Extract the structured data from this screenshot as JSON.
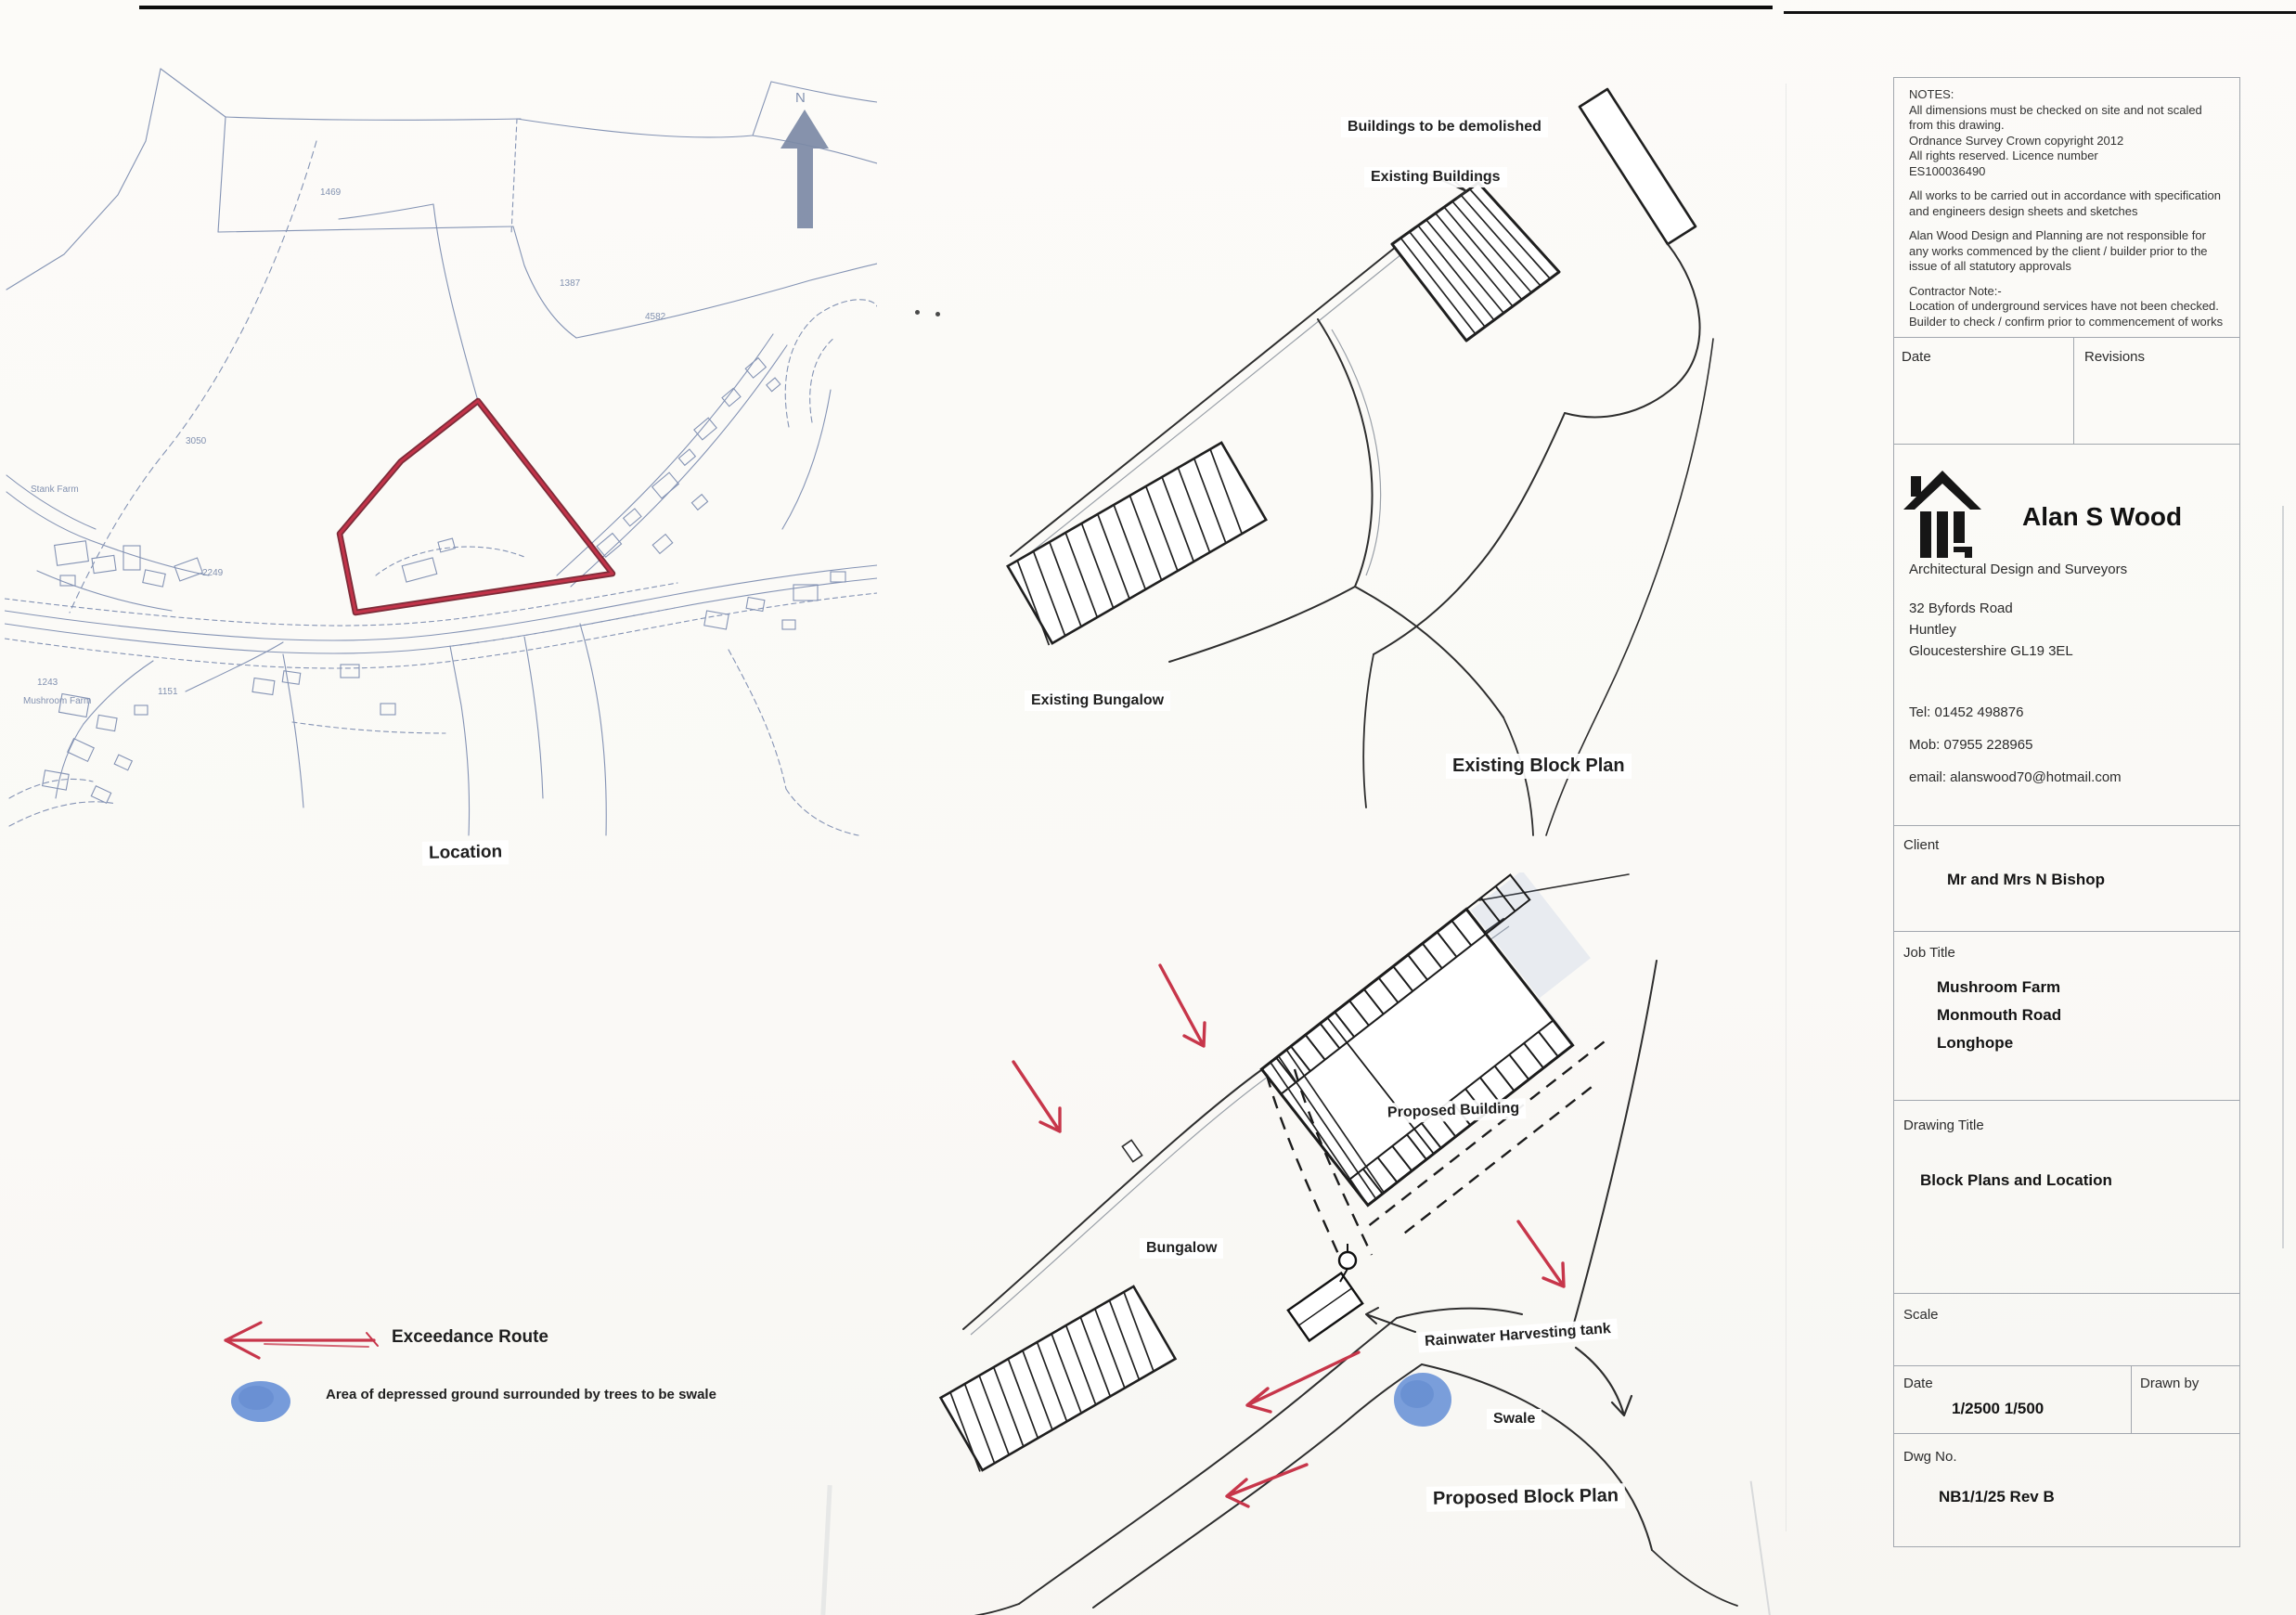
{
  "drawing": {
    "location_map": {
      "title": "Location",
      "north_label": "N",
      "parcel_numbers": [
        "1469",
        "1387",
        "4582",
        "3050",
        "2249",
        "1151",
        "1243"
      ],
      "farm_labels": [
        "Stank Farm",
        "Mushroom Farm"
      ],
      "site_boundary_color": "#c23349"
    },
    "existing_plan": {
      "demolish_label": "Buildings to be demolished",
      "existing_buildings_label": "Existing Buildings",
      "existing_bungalow_label": "Existing Bungalow",
      "title": "Existing Block Plan"
    },
    "proposed_plan": {
      "proposed_building_label": "Proposed Building",
      "bungalow_label": "Bungalow",
      "rainwater_tank_label": "Rainwater Harvesting tank",
      "swale_label": "Swale",
      "title": "Proposed Block Plan",
      "exceedance_arrow_color": "#c7364a",
      "swale_color": "#6f96d8"
    },
    "legend": {
      "exceedance_route_label": "Exceedance Route",
      "depressed_ground_label": "Area of depressed ground surrounded by trees to be swale"
    }
  },
  "title_block": {
    "notes": {
      "heading": "NOTES:",
      "lines": [
        "All dimensions must be checked on site and not scaled from this drawing.",
        "Ordnance Survey Crown copyright 2012",
        "All rights reserved. Licence number",
        "ES100036490",
        "All works to be carried out in accordance with specification and engineers design sheets and sketches",
        "Alan Wood Design and Planning are not responsible for any works commenced by the client / builder prior to the issue of all statutory approvals",
        "Contractor Note:-",
        "Location of underground services have not been checked. Builder to check / confirm prior to commencement of works"
      ]
    },
    "revisions_header": {
      "date_label": "Date",
      "revisions_label": "Revisions"
    },
    "company": {
      "name": "Alan S Wood",
      "tagline": "Architectural Design and Surveyors",
      "address_lines": [
        "32 Byfords Road",
        "Huntley",
        "Gloucestershire GL19 3EL"
      ],
      "tel": "Tel: 01452 498876",
      "mob": "Mob: 07955 228965",
      "email": "email: alanswood70@hotmail.com"
    },
    "client": {
      "label": "Client",
      "value": "Mr and Mrs N Bishop"
    },
    "job": {
      "label": "Job Title",
      "lines": [
        "Mushroom Farm",
        "Monmouth Road",
        "Longhope"
      ]
    },
    "drawing_title": {
      "label": "Drawing Title",
      "value": "Block Plans and Location"
    },
    "scale": {
      "label": "Scale"
    },
    "date_drawn": {
      "date_label": "Date",
      "date_value": "1/2500  1/500",
      "drawn_by_label": "Drawn by"
    },
    "dwg": {
      "label": "Dwg No.",
      "value": "NB1/1/25 Rev B"
    }
  }
}
